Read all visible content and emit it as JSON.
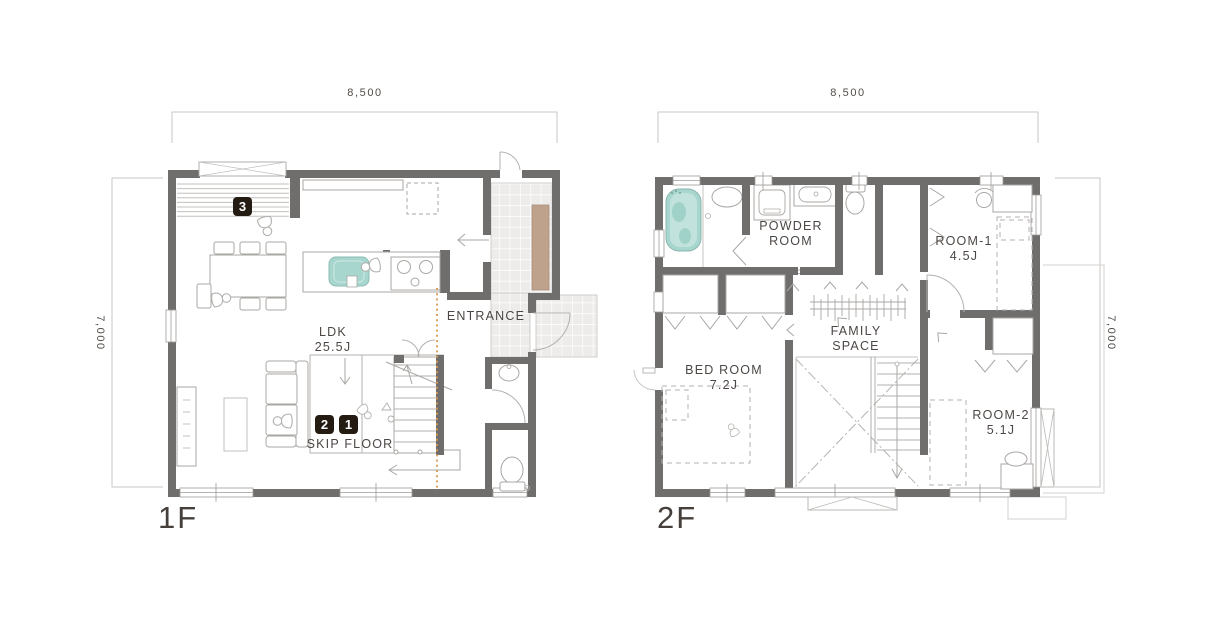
{
  "colors": {
    "wall": "#6f6e6c",
    "line_light": "#a9a7a4",
    "accent_teal": "#a7d6ce",
    "accent_wood": "#bfa28b",
    "badge_bg": "#241b12",
    "badge_text": "#ffffff",
    "text": "#4c4744",
    "guide_orange": "#d9984e"
  },
  "floor1": {
    "label": "1F",
    "dim_width": "8,500",
    "dim_depth": "7,000",
    "rooms": {
      "ldk": {
        "name": "LDK",
        "size": "25.5J"
      },
      "entrance": {
        "name": "ENTRANCE"
      },
      "skip_floor": {
        "name": "SKIP FLOOR"
      }
    },
    "markers": {
      "m1": "1",
      "m2": "2",
      "m3": "3"
    }
  },
  "floor2": {
    "label": "2F",
    "dim_width": "8,500",
    "dim_depth": "7,000",
    "rooms": {
      "powder_room": {
        "name": "POWDER ROOM"
      },
      "room1": {
        "name": "ROOM-1",
        "size": "4.5J"
      },
      "family_space": {
        "name": "FAMILY SPACE"
      },
      "bed_room": {
        "name": "BED ROOM",
        "size": "7.2J"
      },
      "room2": {
        "name": "ROOM-2",
        "size": "5.1J"
      }
    }
  }
}
